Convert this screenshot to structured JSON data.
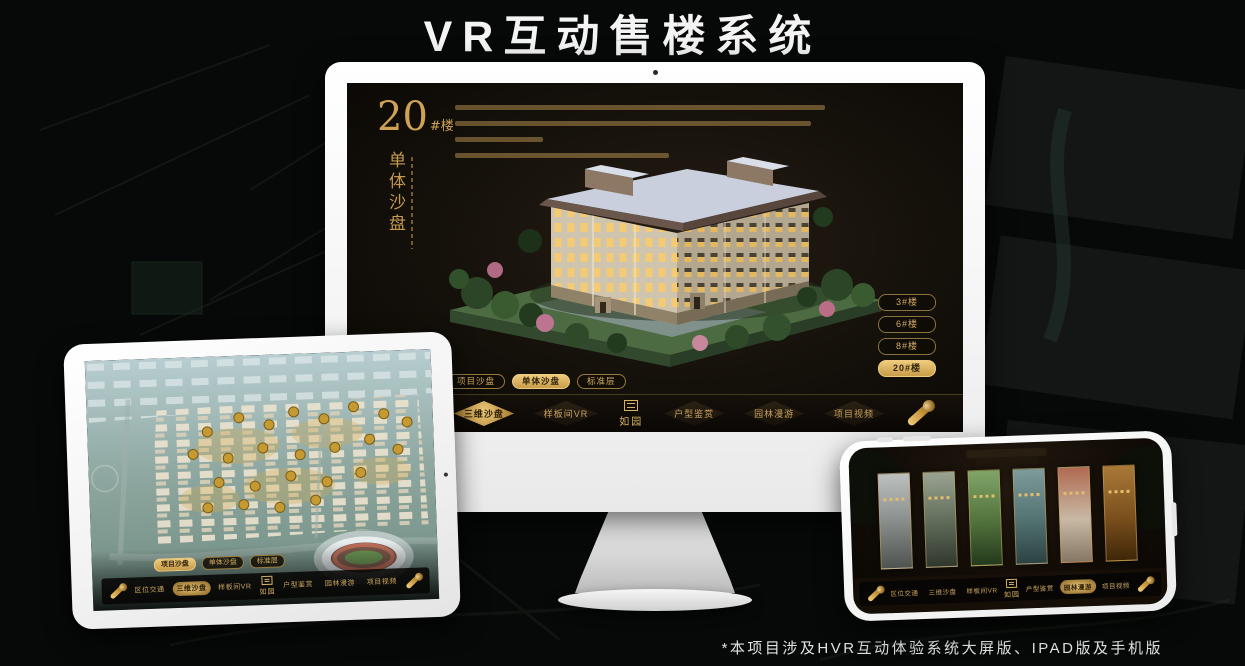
{
  "page": {
    "title": "VR互动售楼系统",
    "footnote": "*本项目涉及HVR互动体验系统大屏版、IPAD版及手机版"
  },
  "colors": {
    "gold_accent": "#d4a94f",
    "gold_text": "#c8a25c",
    "active_fill": "#eecb7e",
    "screen_bg": "#14100a"
  },
  "monitor_app": {
    "block": {
      "number": "20",
      "unit": "#楼",
      "name": "单体沙盘"
    },
    "floor_buttons": [
      {
        "label": "3#楼",
        "active": false
      },
      {
        "label": "6#楼",
        "active": false
      },
      {
        "label": "8#楼",
        "active": false
      },
      {
        "label": "20#楼",
        "active": true
      }
    ],
    "tabs": [
      {
        "label": "项目沙盘",
        "active": false
      },
      {
        "label": "单体沙盘",
        "active": true
      },
      {
        "label": "标准层",
        "active": false
      }
    ],
    "menu": [
      {
        "label": "区位交通",
        "active": false
      },
      {
        "label": "三维沙盘",
        "active": true
      },
      {
        "label": "样板间VR",
        "active": false
      },
      {
        "label": "户型鉴赏",
        "active": false
      },
      {
        "label": "园林漫游",
        "active": false
      },
      {
        "label": "项目视频",
        "active": false
      }
    ],
    "logo": "如园"
  },
  "ipad_app": {
    "tabs": [
      {
        "label": "项目沙盘",
        "active": true
      },
      {
        "label": "单体沙盘",
        "active": false
      },
      {
        "label": "标准层",
        "active": false
      }
    ],
    "menu": [
      {
        "label": "区位交通",
        "active": false
      },
      {
        "label": "三维沙盘",
        "active": true
      },
      {
        "label": "样板间VR",
        "active": false
      },
      {
        "label": "户型鉴赏",
        "active": false
      },
      {
        "label": "园林漫游",
        "active": false
      },
      {
        "label": "项目视频",
        "active": false
      }
    ],
    "logo": "如园"
  },
  "phone_app": {
    "menu": [
      {
        "label": "区位交通",
        "active": false
      },
      {
        "label": "三维沙盘",
        "active": false
      },
      {
        "label": "样板间VR",
        "active": false
      },
      {
        "label": "户型鉴赏",
        "active": false
      },
      {
        "label": "园林漫游",
        "active": true
      },
      {
        "label": "项目视频",
        "active": false
      }
    ],
    "logo": "如园"
  }
}
